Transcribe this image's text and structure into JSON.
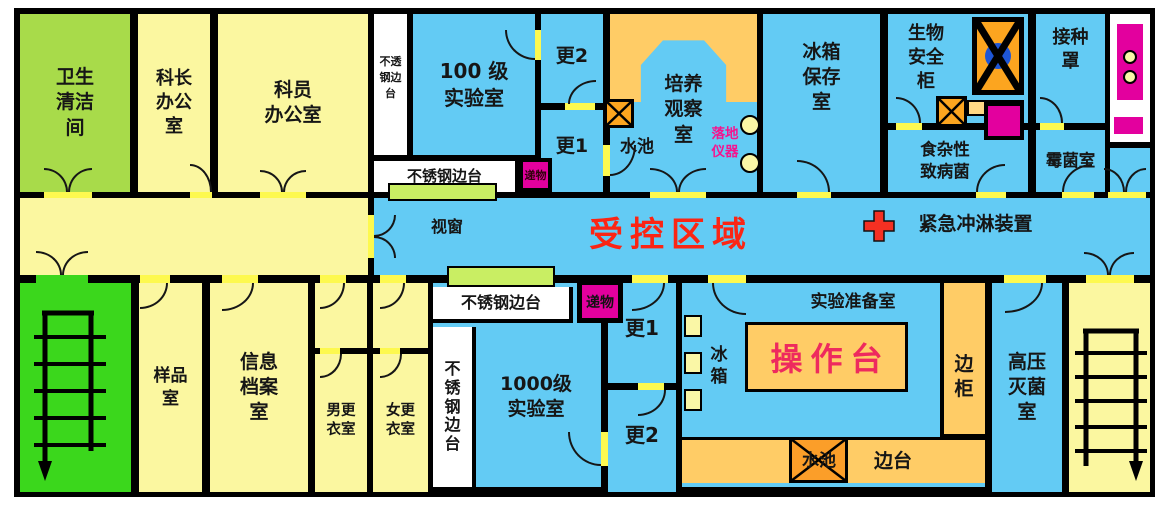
{
  "colors": {
    "room_blue": "#63CBF4",
    "room_yellow": "#FBF7A0",
    "clean_room_green": "#A8DB4A",
    "stair_room_green": "#3BD71C",
    "bench_orange": "#FFCC66",
    "sink_orange": "#FCA51F",
    "pass_magenta": "#E3009E",
    "window_green": "#C9EE63",
    "controlled_red": "#FB2514",
    "worktop_pink": "#EE2A5E",
    "wall_black": "#000000",
    "door_yellow": "#FDF94F",
    "cabinet_blue": "#1E56D6"
  },
  "rooms": {
    "hygiene": "卫生\n清洁\n间",
    "chief": "科长\n办公\n室",
    "staff": "科员\n办公室",
    "lab100": "100 级\n实验室",
    "geng2_top": "更2",
    "geng1_top": "更1",
    "culture": "培养\n观察\n室",
    "fridge_storage": "冰箱\n保存\n室",
    "biosafety": "生物\n安全\n柜",
    "foodborne": "食杂性\n致病菌",
    "inoculation": "接种\n罩",
    "mold": "霉菌室",
    "sample": "样品\n室",
    "archive": "信息\n档案\n室",
    "male_changing": "男更\n衣室",
    "female_changing": "女更\n衣室",
    "lab1000": "1000级\n实验室",
    "geng1_bottom": "更1",
    "geng2_bottom": "更2",
    "prep": "实验准备室",
    "autoclave": "高压\n灭菌\n室"
  },
  "corridor": {
    "window_label": "视窗",
    "controlled_area": "受控区域",
    "emergency_shower": "紧急冲淋装置"
  },
  "fixtures": {
    "bench_top_vertical": "不透\n钢边\n台",
    "bench_under_lab100": "不锈钢边台",
    "pass_top": "递物",
    "sink_top": "水池",
    "floor_instrument": "落地\n仪器",
    "bench_bottom_h": "不锈钢边台",
    "bench_bottom_v": "不\n锈\n钢\n边\n台",
    "pass_bottom": "递物",
    "fridge": "冰\n箱",
    "worktop": "操作台",
    "side_cabinet": "边\n柜",
    "sink_bottom": "水池",
    "side_bench": "边台"
  }
}
